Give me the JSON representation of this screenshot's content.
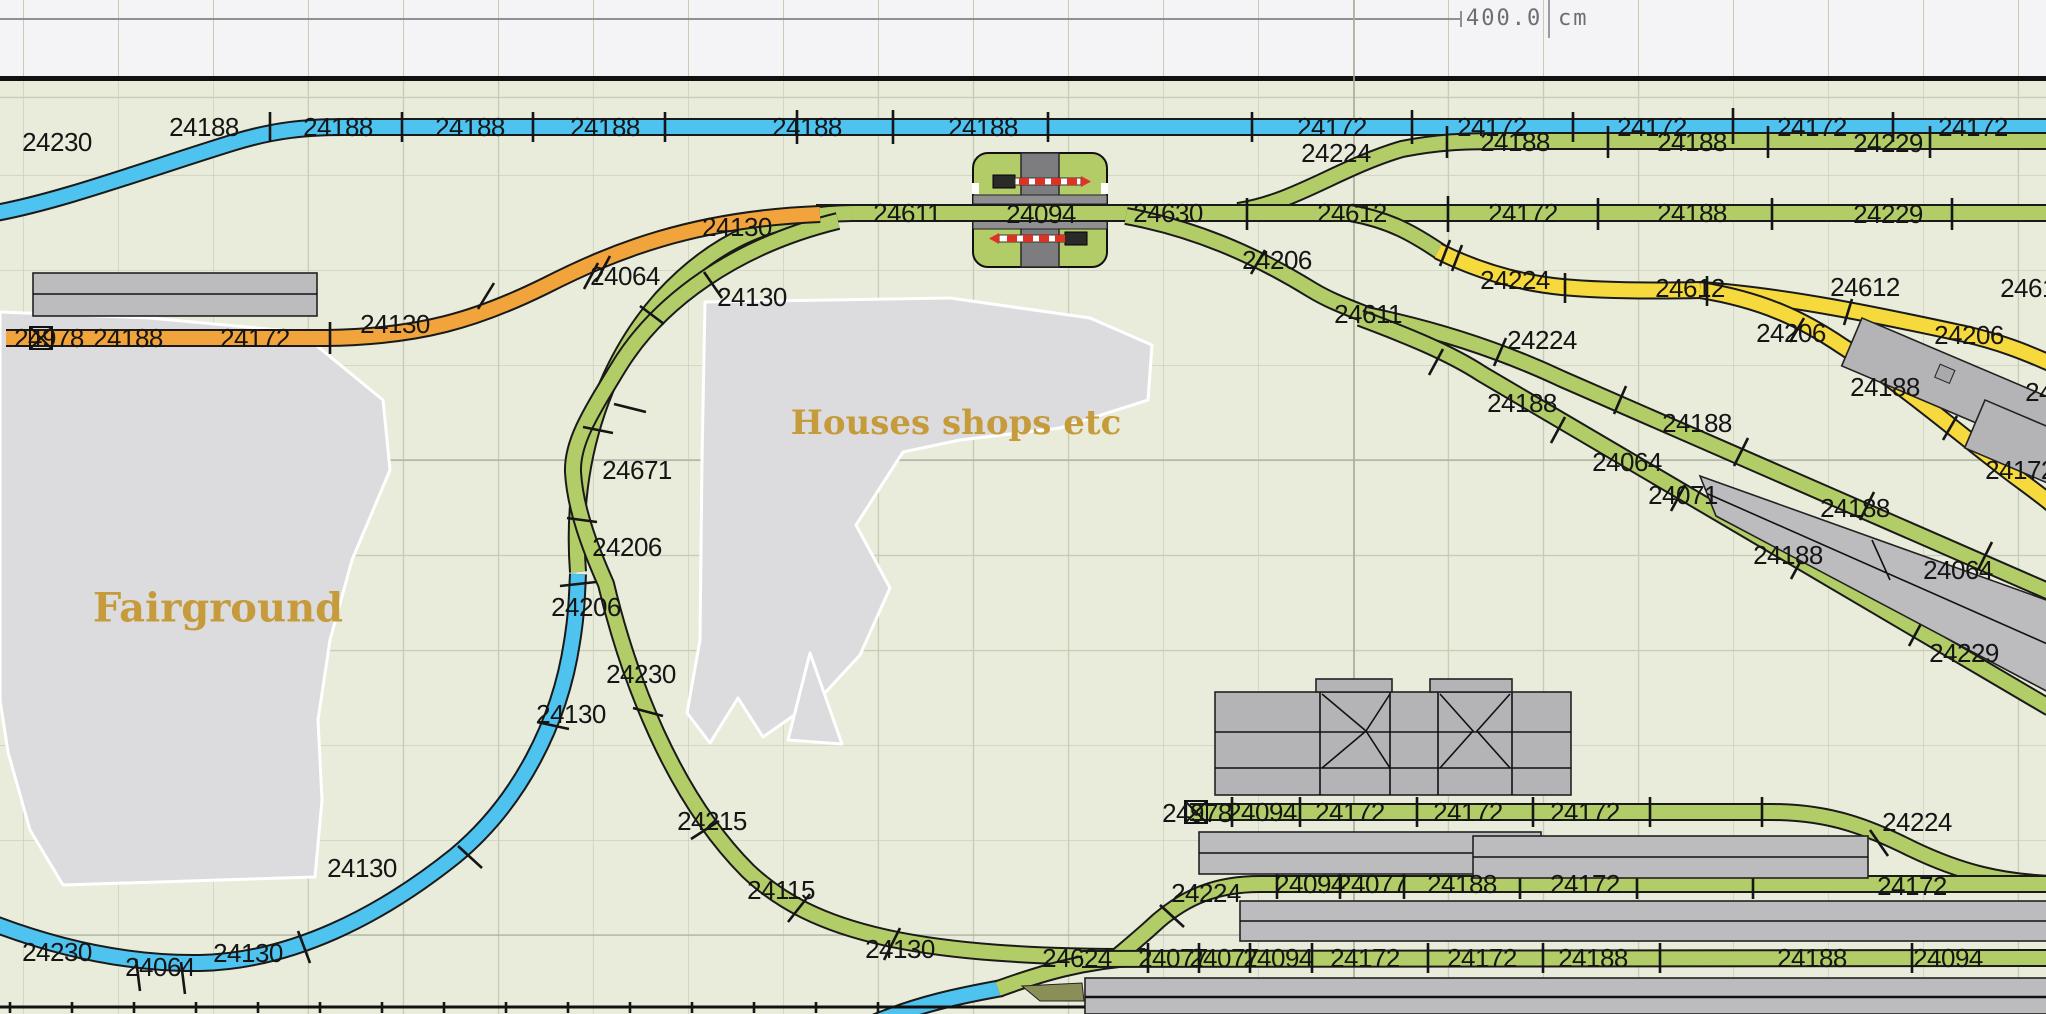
{
  "ruler": {
    "dimension_value": "400.0",
    "unit": "cm"
  },
  "areas": {
    "fairground": "Fairground",
    "houses": "Houses shops etc"
  },
  "colors": {
    "canvas_bg": "#e9ecdb",
    "ruler_bg": "#f4f4f6",
    "grid_line": "#c6cdb6",
    "grid_major": "#a6ac9a",
    "track_blue": "#4ec3ef",
    "track_green": "#b2cd67",
    "track_yellow": "#f6da3d",
    "track_orange": "#f2a43c",
    "platform": "#bcbcbe",
    "area": "#dcdcde",
    "building": "#b4b4b6",
    "road": "#7d7d7f",
    "barrier_red": "#e03224",
    "label_gold": "#c59b3b",
    "ruler_text": "#6d6d72",
    "rail_edge": "#1a1a1a"
  },
  "track_labels": [
    {
      "t": "24230",
      "x": 57,
      "y": 142
    },
    {
      "t": "24188",
      "x": 204,
      "y": 127
    },
    {
      "t": "24188",
      "x": 338,
      "y": 127
    },
    {
      "t": "24188",
      "x": 470,
      "y": 127
    },
    {
      "t": "24188",
      "x": 605,
      "y": 127
    },
    {
      "t": "24188",
      "x": 807,
      "y": 127
    },
    {
      "t": "24188",
      "x": 983,
      "y": 127
    },
    {
      "t": "24172",
      "x": 1332,
      "y": 127
    },
    {
      "t": "24172",
      "x": 1492,
      "y": 127
    },
    {
      "t": "24172",
      "x": 1652,
      "y": 127
    },
    {
      "t": "24172",
      "x": 1812,
      "y": 127
    },
    {
      "t": "24172",
      "x": 1973,
      "y": 127
    },
    {
      "t": "24224",
      "x": 1336,
      "y": 153
    },
    {
      "t": "24188",
      "x": 1515,
      "y": 142
    },
    {
      "t": "24188",
      "x": 1692,
      "y": 142
    },
    {
      "t": "24229",
      "x": 1888,
      "y": 143
    },
    {
      "t": "24611",
      "x": 907,
      "y": 213
    },
    {
      "t": "24094",
      "x": 1041,
      "y": 214
    },
    {
      "t": "24630",
      "x": 1168,
      "y": 213
    },
    {
      "t": "24612",
      "x": 1352,
      "y": 213
    },
    {
      "t": "24172",
      "x": 1523,
      "y": 213
    },
    {
      "t": "24188",
      "x": 1692,
      "y": 213
    },
    {
      "t": "24229",
      "x": 1888,
      "y": 214
    },
    {
      "t": "24978",
      "x": 49,
      "y": 338
    },
    {
      "t": "24188",
      "x": 128,
      "y": 338
    },
    {
      "t": "24172",
      "x": 255,
      "y": 338
    },
    {
      "t": "24130",
      "x": 395,
      "y": 324
    },
    {
      "t": "24064",
      "x": 625,
      "y": 276
    },
    {
      "t": "24130",
      "x": 737,
      "y": 227
    },
    {
      "t": "24130",
      "x": 752,
      "y": 297
    },
    {
      "t": "24671",
      "x": 637,
      "y": 470
    },
    {
      "t": "24206",
      "x": 627,
      "y": 547
    },
    {
      "t": "24206",
      "x": 586,
      "y": 607
    },
    {
      "t": "24130",
      "x": 571,
      "y": 714
    },
    {
      "t": "24230",
      "x": 641,
      "y": 674
    },
    {
      "t": "24215",
      "x": 712,
      "y": 821
    },
    {
      "t": "24115",
      "x": 781,
      "y": 890
    },
    {
      "t": "24130",
      "x": 900,
      "y": 949
    },
    {
      "t": "24230",
      "x": 57,
      "y": 952
    },
    {
      "t": "24064",
      "x": 160,
      "y": 967
    },
    {
      "t": "24130",
      "x": 248,
      "y": 953
    },
    {
      "t": "24130",
      "x": 362,
      "y": 868
    },
    {
      "t": "24206",
      "x": 1277,
      "y": 260
    },
    {
      "t": "24611",
      "x": 1368,
      "y": 314
    },
    {
      "t": "24224",
      "x": 1542,
      "y": 340
    },
    {
      "t": "24188",
      "x": 1522,
      "y": 403
    },
    {
      "t": "24188",
      "x": 1697,
      "y": 423
    },
    {
      "t": "24064",
      "x": 1627,
      "y": 462
    },
    {
      "t": "24071",
      "x": 1683,
      "y": 495
    },
    {
      "t": "24188",
      "x": 1855,
      "y": 508
    },
    {
      "t": "24188",
      "x": 1788,
      "y": 555
    },
    {
      "t": "24064",
      "x": 1958,
      "y": 570
    },
    {
      "t": "24229",
      "x": 1964,
      "y": 653
    },
    {
      "t": "24224",
      "x": 1515,
      "y": 280
    },
    {
      "t": "24612",
      "x": 1690,
      "y": 288
    },
    {
      "t": "24612",
      "x": 1865,
      "y": 287
    },
    {
      "t": "24612",
      "x": 2035,
      "y": 288
    },
    {
      "t": "24206",
      "x": 1791,
      "y": 333
    },
    {
      "t": "24206",
      "x": 1969,
      "y": 335
    },
    {
      "t": "24188",
      "x": 1885,
      "y": 387
    },
    {
      "t": "24172",
      "x": 2020,
      "y": 470
    },
    {
      "t": "24188",
      "x": 2060,
      "y": 392
    },
    {
      "t": "24978",
      "x": 1197,
      "y": 813
    },
    {
      "t": "24094",
      "x": 1262,
      "y": 812
    },
    {
      "t": "24172",
      "x": 1350,
      "y": 812
    },
    {
      "t": "24172",
      "x": 1468,
      "y": 812
    },
    {
      "t": "24172",
      "x": 1585,
      "y": 812
    },
    {
      "t": "24224",
      "x": 1917,
      "y": 822
    },
    {
      "t": "24224",
      "x": 1206,
      "y": 893
    },
    {
      "t": "24094",
      "x": 1310,
      "y": 884
    },
    {
      "t": "24077",
      "x": 1372,
      "y": 884
    },
    {
      "t": "24188",
      "x": 1462,
      "y": 884
    },
    {
      "t": "24172",
      "x": 1585,
      "y": 884
    },
    {
      "t": "24172",
      "x": 1912,
      "y": 886
    },
    {
      "t": "24624",
      "x": 1077,
      "y": 958
    },
    {
      "t": "24077",
      "x": 1173,
      "y": 958
    },
    {
      "t": "24077",
      "x": 1224,
      "y": 958
    },
    {
      "t": "24094",
      "x": 1278,
      "y": 958
    },
    {
      "t": "24172",
      "x": 1365,
      "y": 958
    },
    {
      "t": "24172",
      "x": 1482,
      "y": 958
    },
    {
      "t": "24188",
      "x": 1593,
      "y": 958
    },
    {
      "t": "24188",
      "x": 1812,
      "y": 958
    },
    {
      "t": "24094",
      "x": 1948,
      "y": 958
    }
  ]
}
